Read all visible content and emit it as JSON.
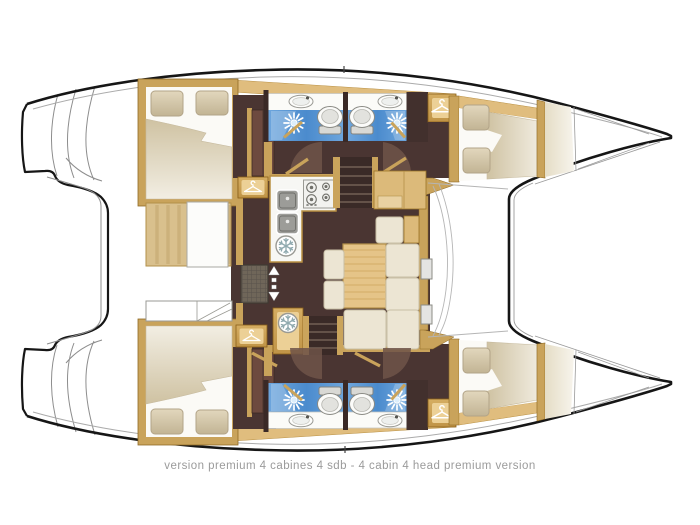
{
  "diagram": {
    "type": "catamaran-floor-plan",
    "caption": "version premium 4 cabines 4 sdb - 4 cabin 4 head premium version",
    "palette": {
      "background": "#ffffff",
      "hull_outline": "#161616",
      "thin_line": "#9a9a9a",
      "wood_tan": "#c9a35b",
      "wood_light": "#ecd096",
      "deck_band": "#e0bd7e",
      "floor_brown": "#4a3532",
      "door_panel_brown": "#6d4a3f",
      "bathroom_blue": "#4f93d6",
      "bed_beige": "#d4c7a7",
      "cushion_cream": "#ece5d3",
      "table_wood": "#e5c488",
      "caption_gray": "#9b9b9b"
    },
    "vessel": {
      "hulls": 2,
      "cabins": 4,
      "heads": 4,
      "port_hull": {
        "aft_cabin": "double berth, 2 pillows",
        "head_aft": "shower, toilet, washbasin",
        "head_forward": "shower, toilet, washbasin",
        "wardrobe": "hanging locker",
        "forward_cabin": "double berth, 2 pillows",
        "forepeak": "bow locker"
      },
      "starboard_hull": {
        "aft_cabin": "double berth, 2 pillows",
        "head_aft": "shower, toilet, washbasin",
        "head_forward": "shower, toilet, washbasin",
        "wardrobe": "hanging locker",
        "forward_cabin": "double berth, 2 pillows",
        "forepeak": "bow locker"
      },
      "saloon": {
        "galley": [
          "double sink",
          "4-burner stove",
          "fridge"
        ],
        "dinette": "wood table with L-shaped settee",
        "companionway_stairs": 2,
        "sliding_door": "aft entry with mat and arrow"
      },
      "cockpit": "aft bench with table and lockers",
      "foredeck": "trampoline between bows",
      "stern": "transom steps and aft platform"
    },
    "icons": {
      "hanger": "wardrobe hanging locker",
      "snowflake": "fridge / cold storage",
      "sunburst": "shower head",
      "double_arrow": "sliding door direction"
    }
  }
}
